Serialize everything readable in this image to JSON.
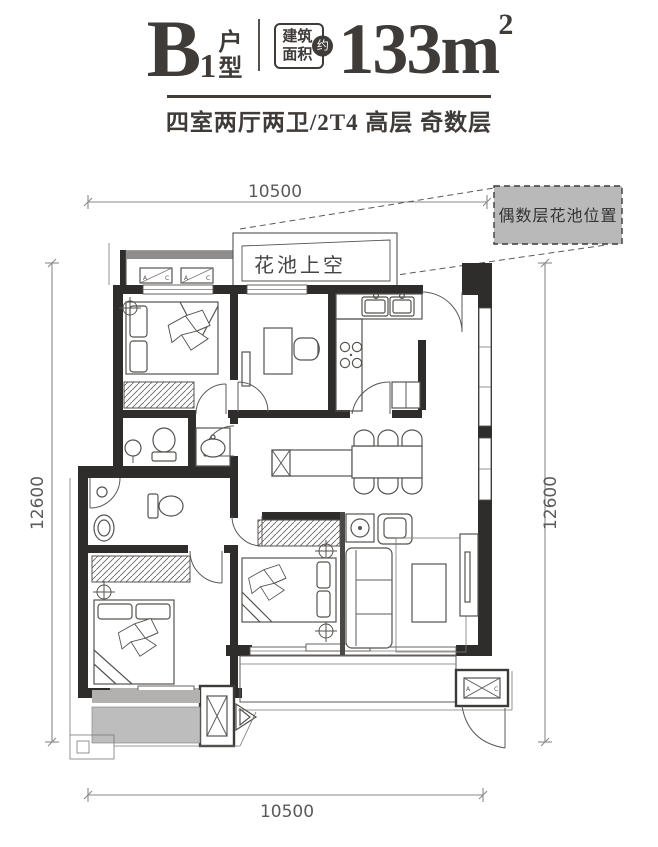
{
  "header": {
    "unit_letter": "B",
    "unit_sub": "1",
    "unit_type_char1": "户",
    "unit_type_char2": "型",
    "area_label_line1": "建筑",
    "area_label_line2": "面积",
    "area_approx_badge": "约",
    "area_value": "133m",
    "area_exponent": "2",
    "subtitle": "四室两厅两卫/2T4 高层 奇数层"
  },
  "plan": {
    "dimensions": {
      "top": "10500",
      "bottom": "10500",
      "left": "12600",
      "right": "12600"
    },
    "labels": {
      "flower_pool_void": "花池上空",
      "even_floor_flower_pool": "偶数层花池位置",
      "ac_letter_a": "A",
      "ac_letter_c": "C"
    },
    "colors": {
      "wall": "#2f2d2b",
      "line": "#55534f",
      "dim": "#5a5a5a",
      "gray_fill": "#bdbdbd",
      "note_fill": "#b9b9b9",
      "text": "#3e3b39"
    }
  }
}
